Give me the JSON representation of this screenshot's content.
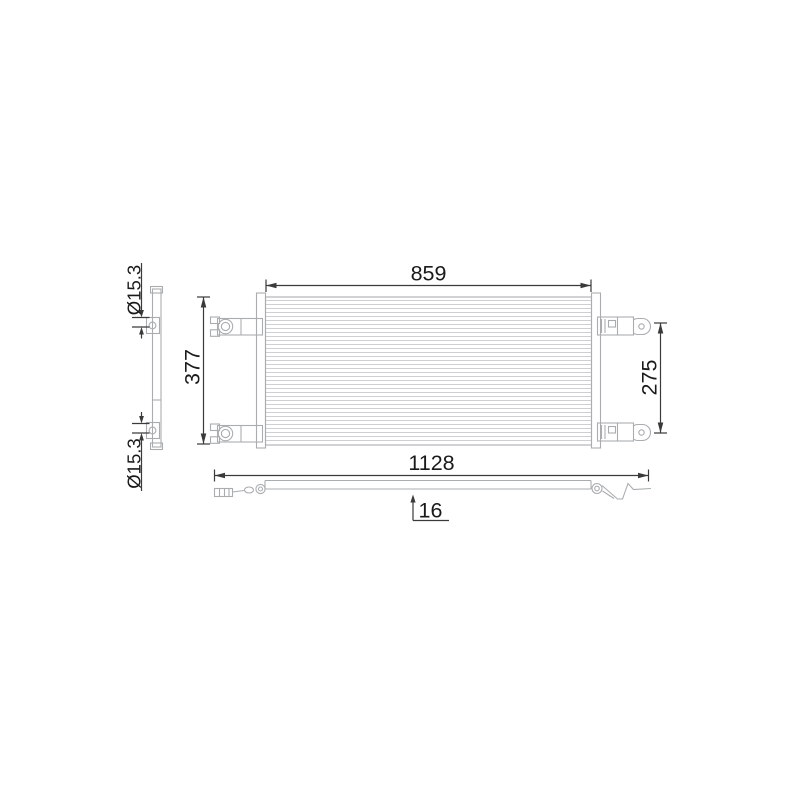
{
  "drawing": {
    "labels": {
      "core_width": "859",
      "overall_height": "377",
      "mounting_span": "275",
      "overall_width": "1128",
      "depth": "16",
      "top_port_diameter": "Ø15.3",
      "bottom_port_diameter": "Ø15.3"
    },
    "colors": {
      "background": "#ffffff",
      "part_line": "#a9adb0",
      "fin_line": "#cdd0d2",
      "dimension_line": "#3a3a3a",
      "label_text": "#1a1a1a"
    }
  }
}
